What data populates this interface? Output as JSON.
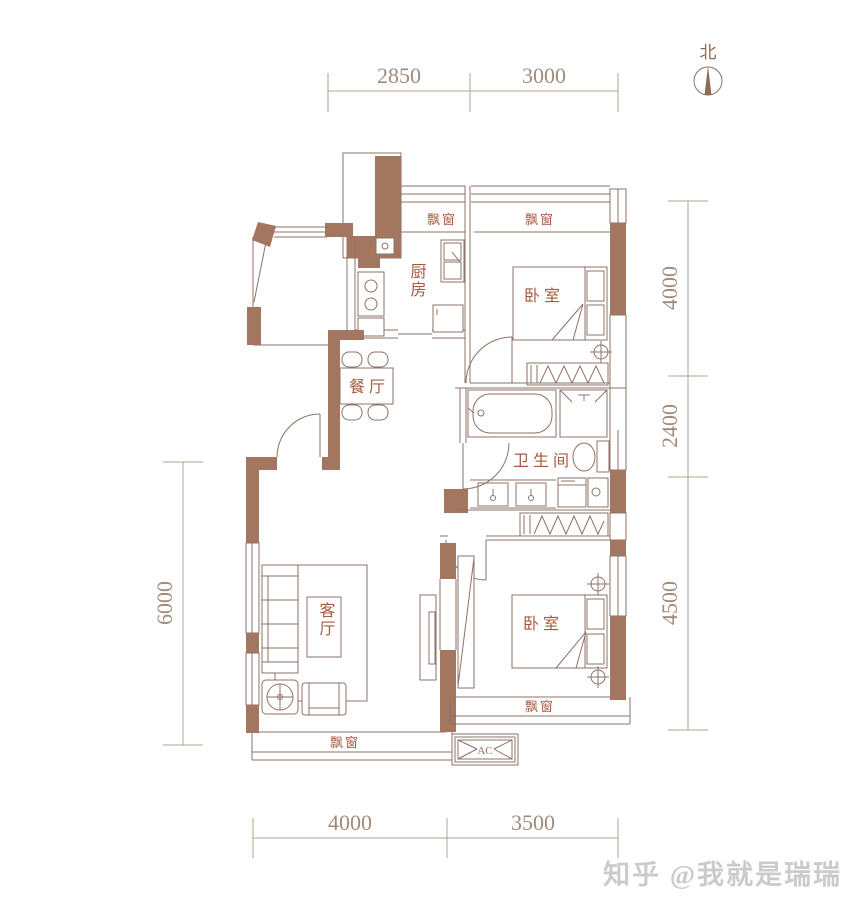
{
  "north": {
    "label": "北"
  },
  "dimensions": {
    "top": [
      "2850",
      "3000"
    ],
    "right": [
      "4000",
      "2400",
      "4500"
    ],
    "left": [
      "6000"
    ],
    "bottom": [
      "4000",
      "3500"
    ]
  },
  "rooms": {
    "kitchen": "厨房",
    "bedroom_top": "卧室",
    "dining": "餐厅",
    "bathroom": "卫生间",
    "living": "客厅",
    "bedroom_bottom": "卧室"
  },
  "bay_window_labels": {
    "kitchen": "飘窗",
    "bedroom_top": "飘窗",
    "living": "飘窗",
    "bedroom_bottom": "飘窗"
  },
  "equipment": {
    "ac": "AC"
  },
  "watermark": "知乎 @我就是瑞瑞",
  "colors": {
    "wall": "#a3765f",
    "line": "#8d7265",
    "label": "#a55a41",
    "dim": "#a08a7a",
    "dimline": "#b3a092",
    "north": "#8f6a55",
    "watermark": "#cbcbcb",
    "bg": "#ffffff"
  }
}
